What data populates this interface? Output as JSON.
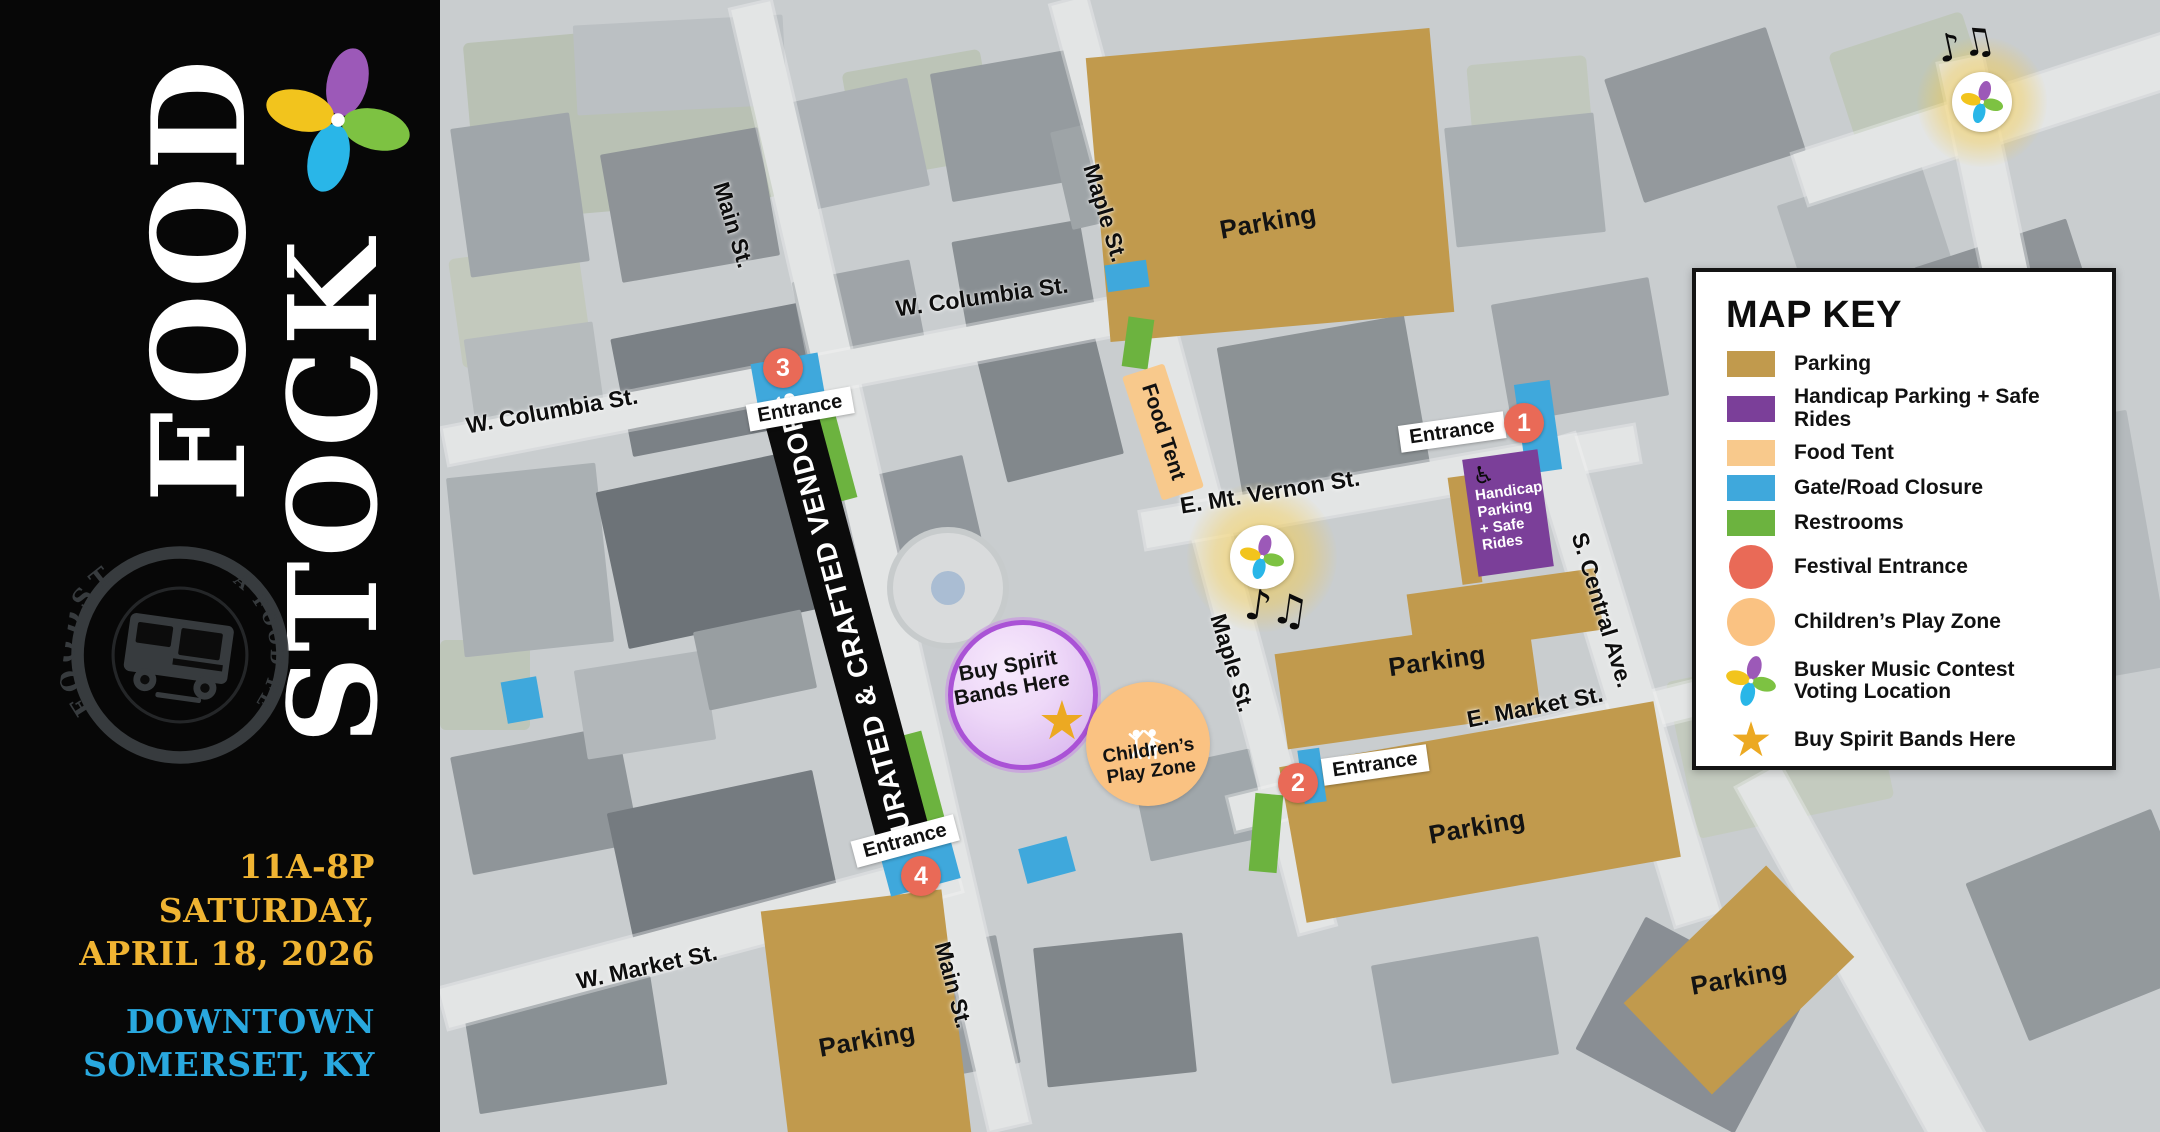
{
  "sidebar": {
    "word_food": "FOOD",
    "word_stock": "STOCK",
    "stamp_arc_left": "FOODSTOCK",
    "stamp_arc_right": "A FOOD FEST",
    "date_line1": "11A-8P SATURDAY,",
    "date_line2": "APRIL 18, 2026",
    "loc_line1": "DOWNTOWN",
    "loc_line2": "SOMERSET, KY"
  },
  "colors": {
    "parking": "#C19A4D",
    "handicap": "#7B3F99",
    "foodtent": "#F8C98C",
    "gate": "#3FA8DC",
    "restroom": "#6CB33F",
    "entrance": "#E96A57",
    "children": "#FAC282",
    "star": "#ECA922",
    "datetext": "#F0B432",
    "loctext": "#29A8DF",
    "pinwheel": [
      "#9C59B8",
      "#7DC242",
      "#29B6E8",
      "#F2C41D"
    ]
  },
  "map_key": {
    "title": "MAP KEY",
    "items": [
      {
        "label": "Parking"
      },
      {
        "label": "Handicap Parking + Safe Rides"
      },
      {
        "label": "Food Tent"
      },
      {
        "label": "Gate/Road Closure"
      },
      {
        "label": "Restrooms"
      },
      {
        "label": "Festival Entrance"
      },
      {
        "label": "Children’s Play Zone"
      },
      {
        "label": "Busker Music Contest",
        "label2": "Voting Location"
      },
      {
        "label": "Buy Spirit Bands Here"
      }
    ]
  },
  "streets": {
    "main_upper": "Main St.",
    "main_lower": "Main St.",
    "maple_upper": "Maple St.",
    "maple_lower": "Maple St.",
    "w_columbia_left": "W. Columbia St.",
    "w_columbia_right": "W. Columbia St.",
    "e_mt_vernon": "E. Mt. Vernon St.",
    "e_market": "E. Market St.",
    "w_market": "W. Market St.",
    "s_central": "S. Central Ave."
  },
  "map": {
    "parking_label": "Parking",
    "entrance_label": "Entrance",
    "entrances": [
      {
        "n": "1"
      },
      {
        "n": "2"
      },
      {
        "n": "3"
      },
      {
        "n": "4"
      }
    ],
    "vendors_banner": "CURATED & CRAFTED VENDORS",
    "food_tent": "Food Tent",
    "handicap": {
      "l1": "Handicap",
      "l2": "Parking",
      "l3": "+ Safe",
      "l4": "Rides"
    },
    "buy_spirit": {
      "l1": "Buy Spirit",
      "l2": "Bands Here"
    },
    "children": {
      "l1": "Children’s",
      "l2": "Play Zone"
    },
    "music_notes": "♪♫",
    "handicap_icon": "♿",
    "star_icon": "★"
  }
}
